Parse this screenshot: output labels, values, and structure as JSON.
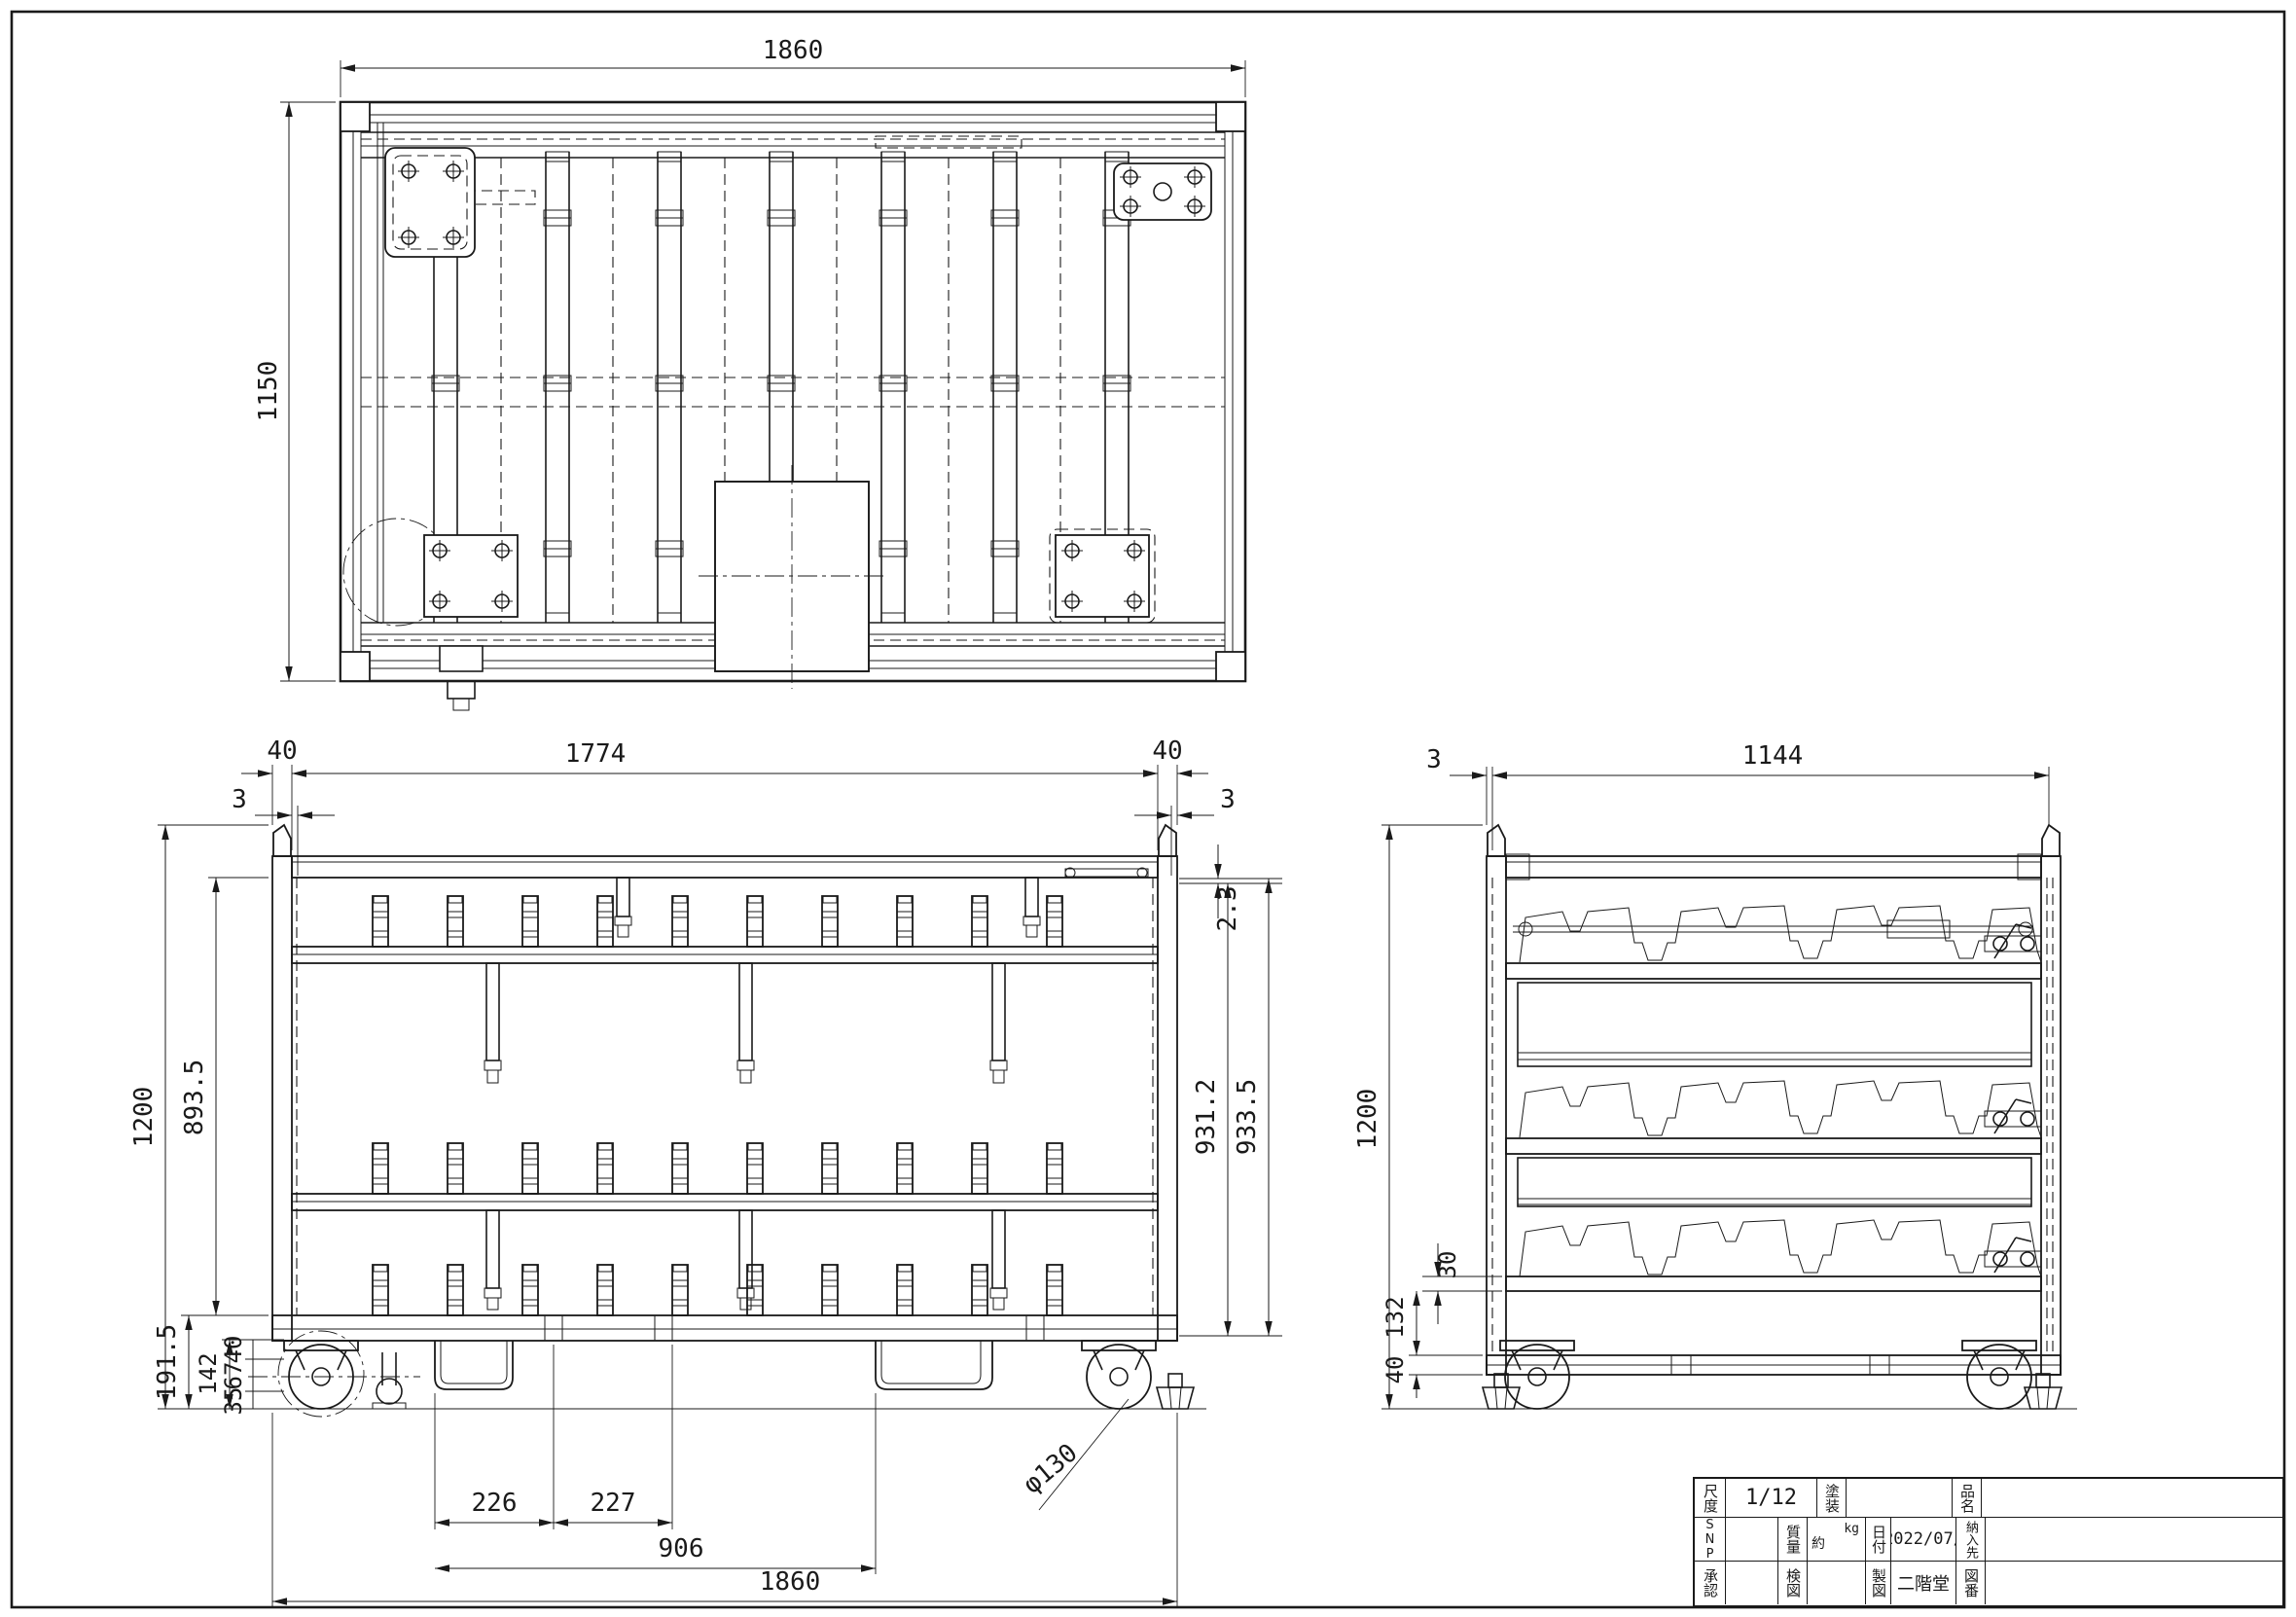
{
  "colors": {
    "ink": "#1a1a1a",
    "paper": "#ffffff"
  },
  "drawing": {
    "top_view": {
      "width": "1860",
      "height": "1150"
    },
    "front_view": {
      "post_left": "40",
      "wall_left": "3",
      "inner_width": "1774",
      "post_right": "40",
      "wall_right": "3",
      "overall_height": "1200",
      "inner_height": "893.5",
      "top_gap": "2.3",
      "body_height": "931.2",
      "body_height_outer": "933.5",
      "base_height": "191.5",
      "caster_height": "142",
      "seg40": "40",
      "seg67": "67",
      "seg35": "35",
      "pitch_left": "226",
      "pitch_right": "227",
      "pocket_span": "906",
      "overall_width": "1860",
      "wheel_diameter": "φ130"
    },
    "side_view": {
      "wall": "3",
      "width": "1144",
      "overall_height": "1200",
      "rail_height": "30",
      "under_clearance": "132",
      "frame_height": "40"
    }
  },
  "title_block": {
    "scale_label": "尺度",
    "scale_value": "1/12",
    "paint_label": "塗装",
    "product_label": "品名",
    "snp_label": "SNP",
    "mass_label": "質量",
    "mass_prefix": "約",
    "mass_unit": "kg",
    "date_label": "日付",
    "date_value": "2022/07/",
    "customer_label": "納入先",
    "approval_label": "承認",
    "check_label": "検図",
    "draft_label": "製図",
    "draft_value": "二階堂",
    "drawing_no_label": "図番"
  }
}
